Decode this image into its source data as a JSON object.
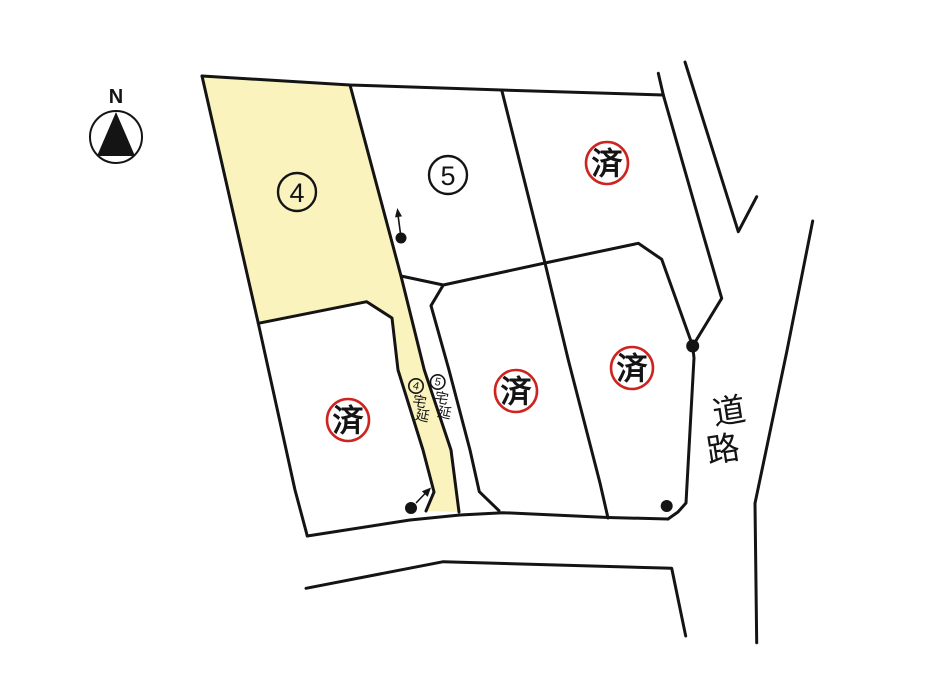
{
  "colors": {
    "highlight": "#FAF3BD",
    "stamp": "#CE2420",
    "line": "#141414"
  },
  "compass": {
    "label": "N"
  },
  "lots": {
    "lot4": {
      "number": "4"
    },
    "lot5": {
      "number": "5"
    },
    "sold_stamp": "済"
  },
  "strips": {
    "s4": {
      "num": "4",
      "c1": "宅",
      "c2": "延"
    },
    "s5": {
      "num": "5",
      "c1": "宅",
      "c2": "延"
    }
  },
  "road": {
    "c1": "道",
    "c2": "路"
  }
}
